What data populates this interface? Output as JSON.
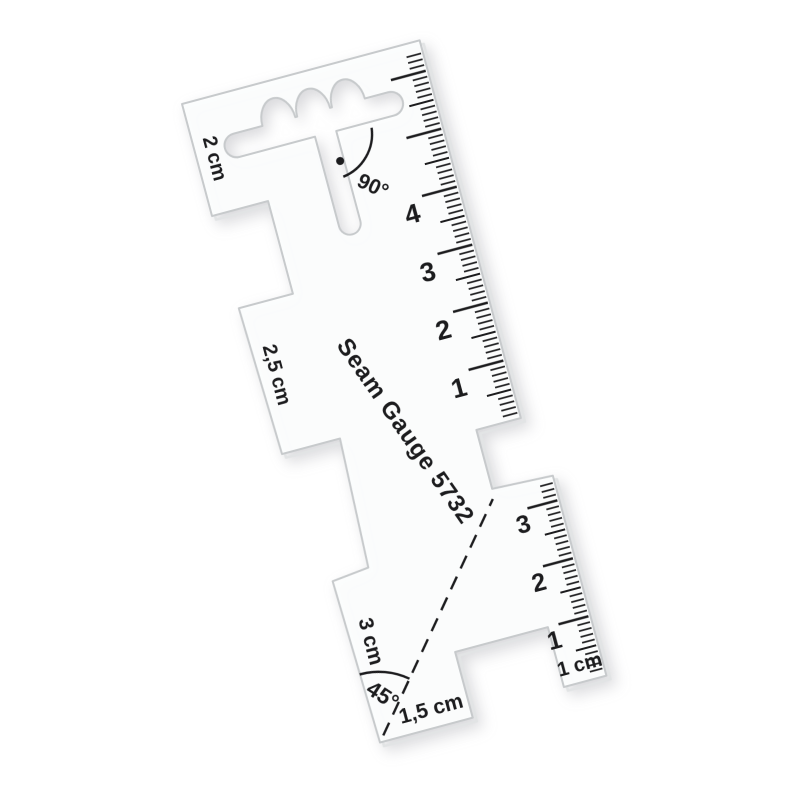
{
  "scene": {
    "background": "#ffffff",
    "subject": "transparent acrylic sewing seam gauge on white background"
  },
  "gauge": {
    "model_label": "Seam Gauge 5732",
    "labels": {
      "head_step": "2 cm",
      "middle_step": "2,5 cm",
      "lower_step": "3 cm",
      "diagonal": "1,5 cm",
      "arm": "1 cm",
      "angle_top": "90°",
      "angle_bottom": "45°"
    },
    "ruler_right_numbers": [
      "4",
      "3",
      "2",
      "1"
    ],
    "ruler_bottom_numbers": [
      "3",
      "2",
      "1"
    ],
    "colors": {
      "body": "#fcfdfd",
      "edge": "#c7cacc",
      "edge_shadow": "#e2e4e5",
      "ink": "#1c1c1e",
      "background": "#ffffff"
    }
  }
}
